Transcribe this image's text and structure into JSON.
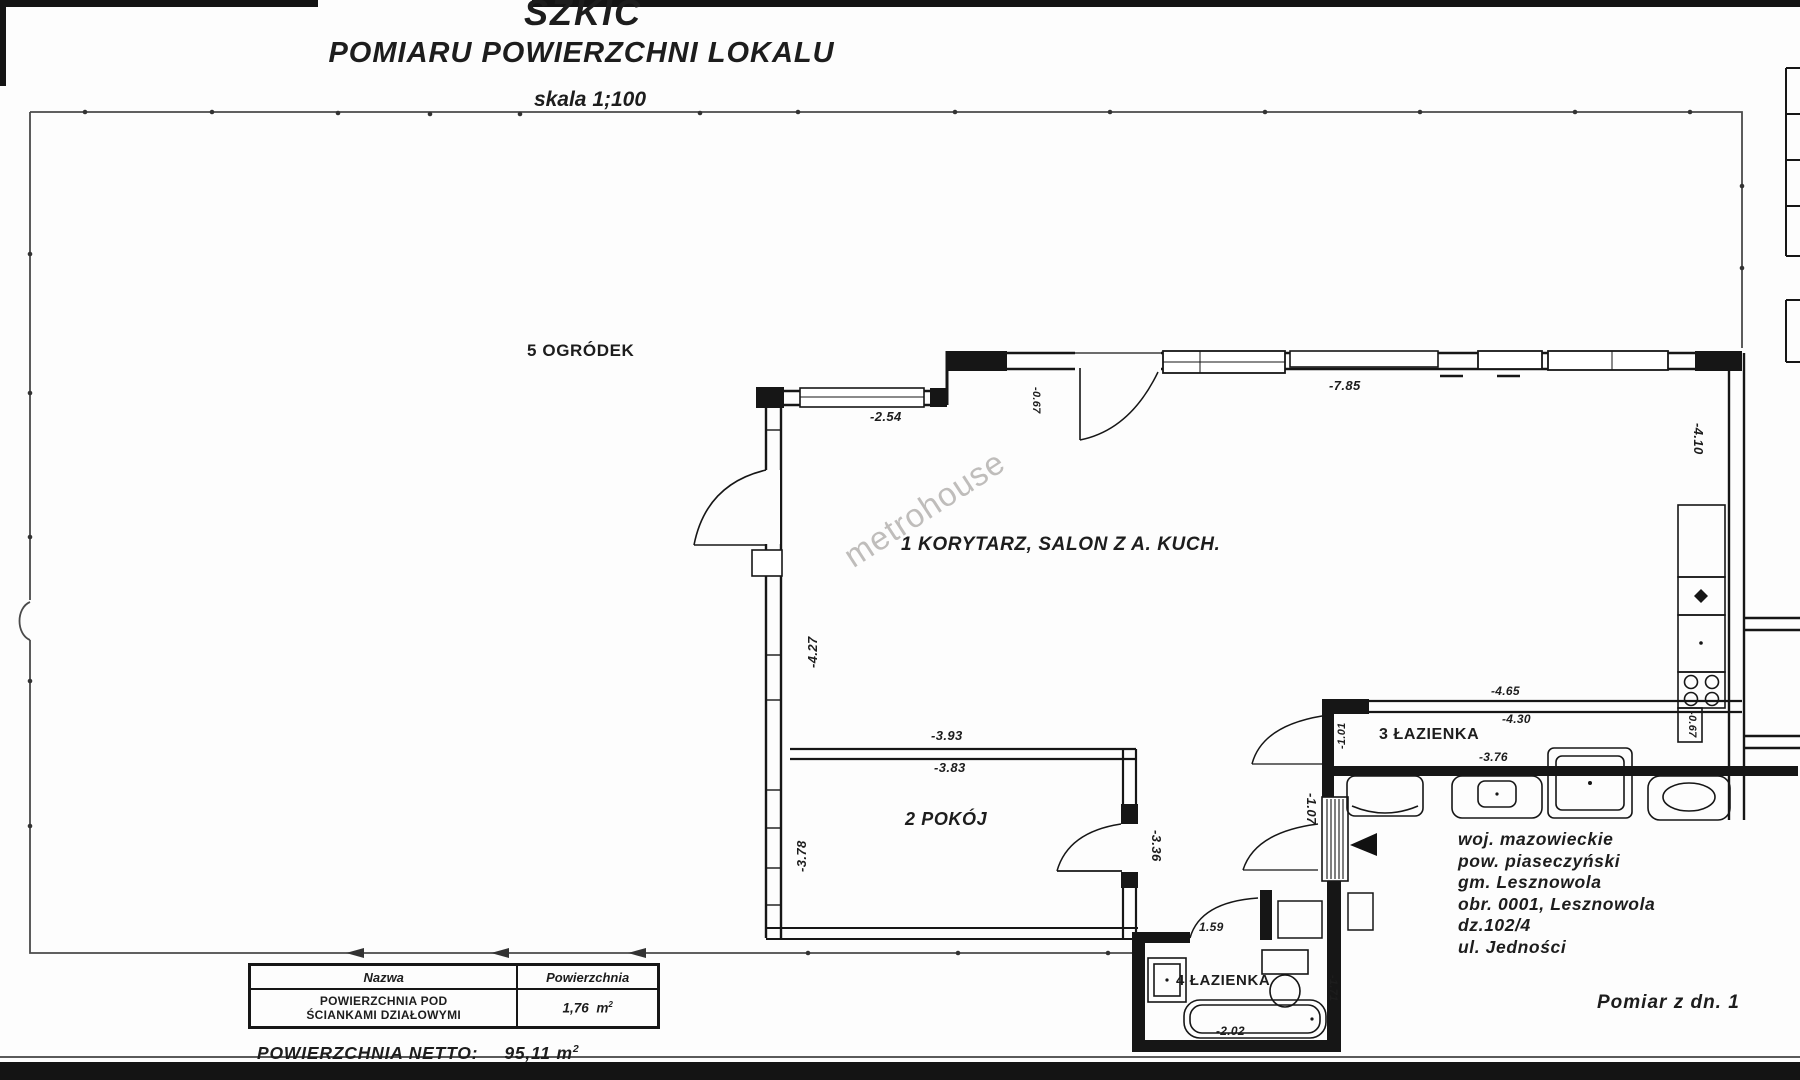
{
  "title": {
    "main": "SZKIC",
    "subtitle": "POMIARU POWIERZCHNI LOKALU",
    "scale": "skala 1;100"
  },
  "watermark": "metrohouse",
  "rooms": {
    "salon": {
      "label": "1 KORYTARZ, SALON Z A. KUCH."
    },
    "pokoj": {
      "label": "2 POKÓJ"
    },
    "lazienka3": {
      "label": "3 ŁAZIENKA"
    },
    "lazienka4": {
      "label": "4 ŁAZIENKA"
    },
    "ogrodek": {
      "label": "5 OGRÓDEK"
    }
  },
  "dims": {
    "top_left_section": "-2.54",
    "top_wall": "-7.85",
    "top_step": "-0.67",
    "right_wall": "-4.10",
    "left_wall": "-4.27",
    "pokoj_width_outer": "-3.93",
    "pokoj_width_inner": "-3.83",
    "pokoj_left": "-3.78",
    "pokoj_right": "-3.36",
    "hall_width": "-1.07",
    "bath3_width_outer": "-4.65",
    "bath3_width_inner": "-4.30",
    "bath3_width": "-3.76",
    "bath3_depth": "-1.01",
    "kitchen_edge": "-0.67",
    "bath4_door": "1.59",
    "bath4_tub": "-2.02",
    "bath4_depth": "-1.71"
  },
  "location": {
    "lines": [
      "woj. mazowieckie",
      "pow. piaseczyński",
      "gm. Lesznowola",
      "obr. 0001, Lesznowola",
      "dz.102/4",
      "ul. Jedności"
    ]
  },
  "measurement_date_note": "Pomiar z dn. 1",
  "area_table": {
    "header": {
      "name": "Nazwa",
      "area": "Powierzchnia"
    },
    "row": {
      "name_line1": "POWIERZCHNIA POD",
      "name_line2": "ŚCIANKAMI DZIAŁOWYMI",
      "value": "1,76",
      "unit": "m",
      "unit_sup": "2"
    }
  },
  "netto": {
    "label": "POWIERZCHNIA NETTO:",
    "value": "95,11",
    "unit": "m",
    "unit_sup": "2"
  }
}
